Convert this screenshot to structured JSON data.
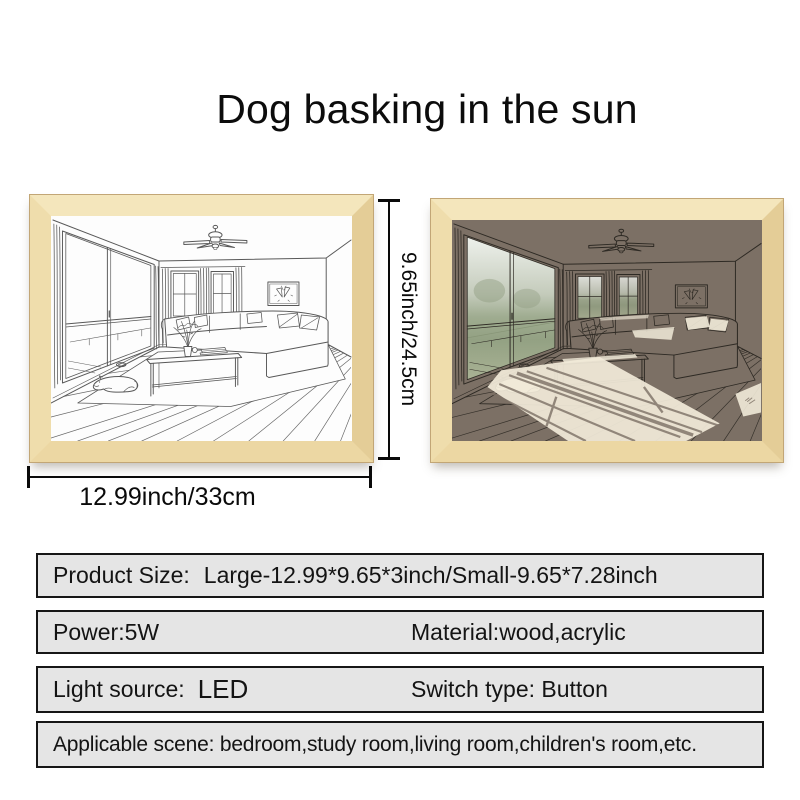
{
  "title": "Dog basking in the sun",
  "dimension_labels": {
    "height": "9.65inch/24.5cm",
    "width": "12.99inch/33cm"
  },
  "frames": [
    {
      "name": "line-art-unlit-frame",
      "scene": "living-room-with-dog-line-drawing"
    },
    {
      "name": "led-lit-frame",
      "scene": "living-room-with-dog-sunlit"
    }
  ],
  "specs": {
    "product_size_label": "Product Size:",
    "product_size_value": "Large-12.99*9.65*3inch/Small-9.65*7.28inch",
    "power": "Power:5W",
    "material": "Material:wood,acrylic",
    "light_source_label": "Light source:",
    "light_source_value": "LED",
    "switch_type": "Switch type: Button",
    "applicable_scene": "Applicable scene: bedroom,study room,living room,children's room,etc."
  },
  "colors": {
    "wood_frame": "#efdcab",
    "lit_scene_overlay": "#7c7065",
    "sunlight": "#f1ead8",
    "line_art": "#585858",
    "spec_box_bg": "#e5e5e5"
  }
}
